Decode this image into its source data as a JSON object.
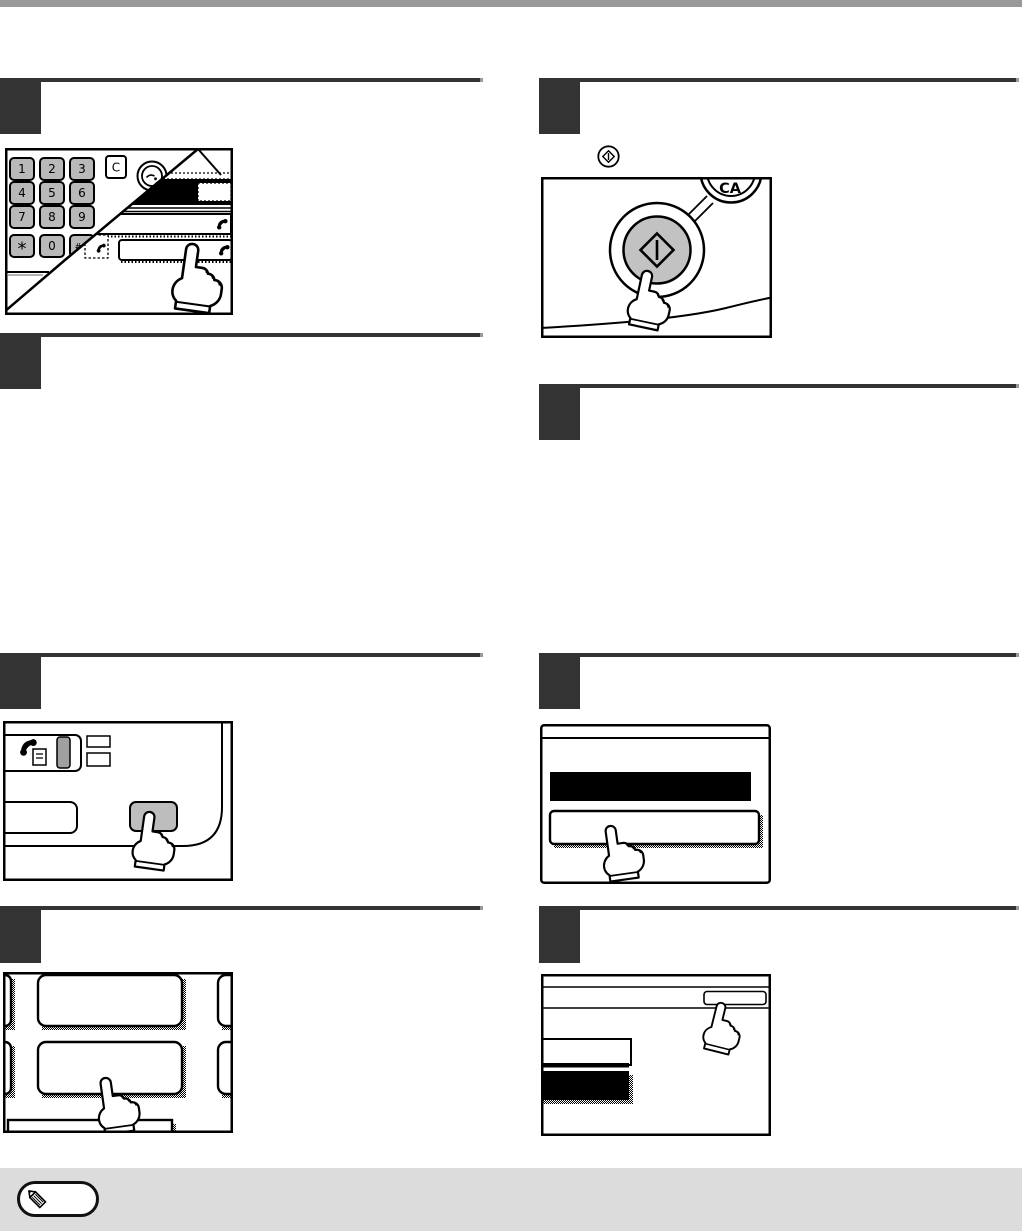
{
  "colors": {
    "page_background": "#ffffff",
    "header_bar": "#999999",
    "step_marker": "#333333",
    "rule_line": "#333333",
    "note_band": "#dcdcdc",
    "keypad_key_gray": "#b9b9b9",
    "start_button_gray": "#c2c2c2",
    "led_bar_gray": "#a0a0a0",
    "panel_button_gray": "#bdbdbd",
    "line_black": "#000000"
  },
  "keypad_illustration": {
    "digit_keys": [
      [
        "1",
        "2",
        "3"
      ],
      [
        "4",
        "5",
        "6"
      ],
      [
        "7",
        "8",
        "9"
      ],
      [
        "*",
        "0",
        "#/P"
      ]
    ],
    "clear_key_label": "C"
  },
  "start_key_illustration": {
    "clear_all_key_label": "CA"
  },
  "icons": {
    "note_icon": "pencil",
    "speed_dial_key_icon": "telephone-handset",
    "start_key_icon": "start-diamond",
    "redial_key_icon": "redial",
    "fax_mode_icon": "fax-phone-with-page",
    "press_cursor": "pointing-hand"
  },
  "steps": {
    "left_count": 4,
    "right_count": 4,
    "marker_text": ""
  }
}
